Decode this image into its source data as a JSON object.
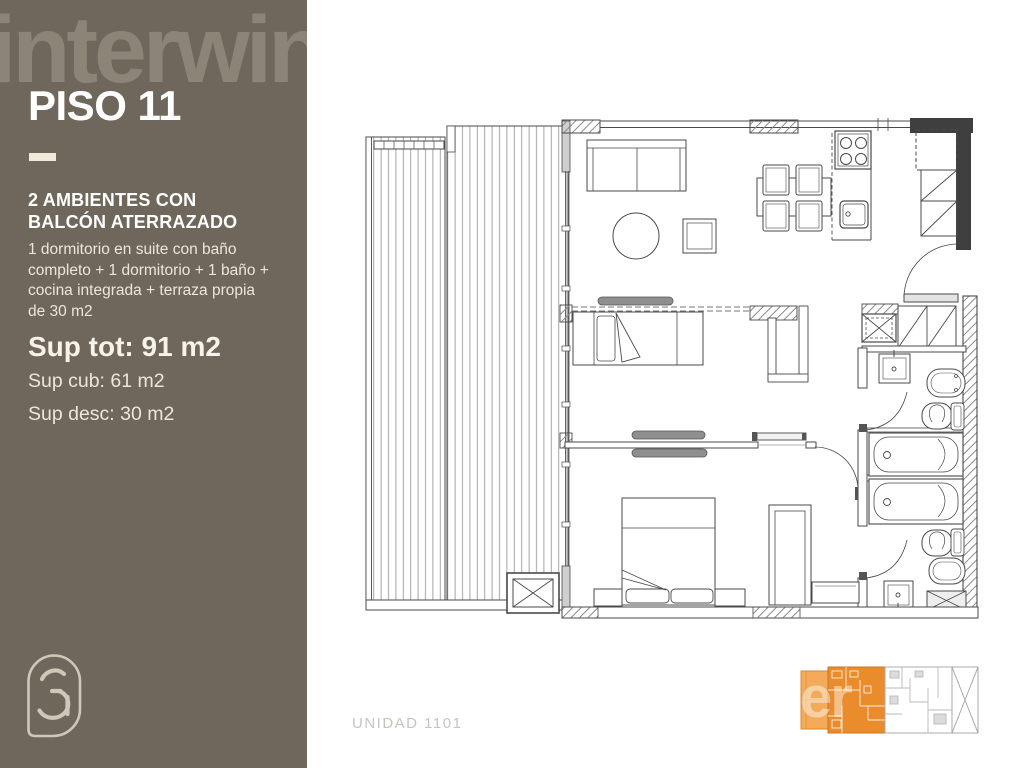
{
  "sidebar": {
    "brand": "interwin",
    "floor_title": "PISO 11",
    "unit_type": "2 AMBIENTES CON BALCÓN ATERRAZADO",
    "description": "1 dormitorio en suite con baño completo + 1 dormitorio + 1 baño + cocina integrada + terraza propia de 30 m2",
    "sup_tot": "Sup tot: 91 m2",
    "sup_cub": "Sup cub: 61 m2",
    "sup_desc": "Sup desc: 30 m2"
  },
  "footer": {
    "unit_label": "UNIDAD 1101"
  },
  "minimap": {
    "watermark": "er",
    "highlight_color": "#EA8C2C",
    "terrace_color": "#F3AA59",
    "neighbor_line_color": "#B9B9B9"
  },
  "colors": {
    "sidebar_bg": "#6F675B",
    "brand_logo": "#8C8577",
    "accent_cream": "#F1EAD9",
    "body_text": "#ECE6DA",
    "muted_label": "#C9C4BD",
    "plan_line": "#4A4A4A",
    "wall_dark": "#3F3F3F"
  },
  "icons": {
    "brand_mark": "3a-monogram-icon"
  }
}
